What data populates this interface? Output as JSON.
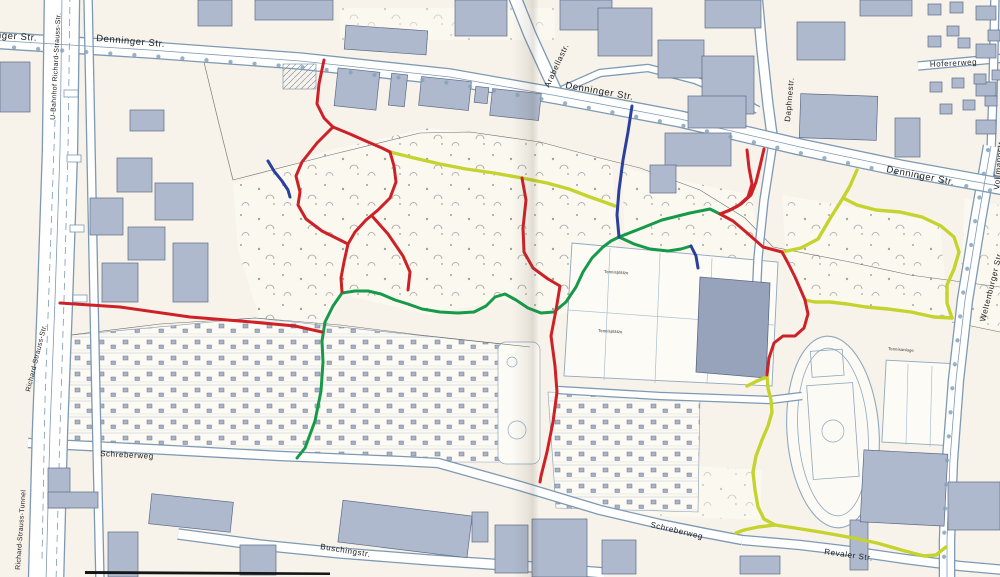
{
  "map": {
    "labels": {
      "denninger_1": "Denninger Str.",
      "denninger_2": "Denninger Str.",
      "denninger_3": "Denninger Str.",
      "denninger_4": "Denninger Str.",
      "arabellastr": "Arabellastr.",
      "daphnestr": "Daphnestr.",
      "hofererweg": "Hofererweg",
      "vollmannstr": "Vollmannstr.",
      "weltenburger": "Weltenburger Str.",
      "u_bahnhof": "U-Bahnhof Richard-Strauss-Str.",
      "richard_strauss_str": "Richard-Strauss-Str.",
      "richard_strauss_tunnel": "Richard-Strauss-Tunnel",
      "schreberweg_west": "Schreberweg",
      "schreberweg_east": "Schreberweg",
      "revaler_str": "Revaler Str.",
      "buschingstr": "Buschingstr.",
      "tennisplaetze_1": "Tennisplätze",
      "tennisplaetze_2": "Tennisplätze",
      "tennisanlage": "Tennisanlage"
    },
    "route_colors": {
      "red": "#cd2027",
      "green": "#169a49",
      "blue": "#2b3f9f",
      "yellow_green": "#c5d32e"
    },
    "routes": [
      {
        "name": "red-west",
        "color": "red",
        "points": [
          [
            60,
            303
          ],
          [
            120,
            307
          ],
          [
            190,
            317
          ],
          [
            252,
            322
          ],
          [
            295,
            326
          ],
          [
            322,
            332
          ]
        ]
      },
      {
        "name": "red-loop-stem",
        "color": "red",
        "points": [
          [
            324,
            60
          ],
          [
            319,
            84
          ],
          [
            317,
            104
          ],
          [
            324,
            118
          ],
          [
            333,
            127
          ]
        ]
      },
      {
        "name": "red-loop-west",
        "color": "red",
        "points": [
          [
            333,
            127
          ],
          [
            317,
            143
          ],
          [
            302,
            162
          ],
          [
            296,
            176
          ],
          [
            300,
            192
          ],
          [
            298,
            205
          ],
          [
            306,
            219
          ],
          [
            322,
            231
          ],
          [
            338,
            239
          ],
          [
            348,
            244
          ]
        ]
      },
      {
        "name": "red-loop-east",
        "color": "red",
        "points": [
          [
            390,
            152
          ],
          [
            394,
            166
          ],
          [
            396,
            182
          ],
          [
            390,
            198
          ],
          [
            378,
            210
          ],
          [
            366,
            220
          ],
          [
            355,
            232
          ],
          [
            348,
            244
          ]
        ]
      },
      {
        "name": "red-loop-north",
        "color": "red",
        "points": [
          [
            333,
            127
          ],
          [
            350,
            134
          ],
          [
            368,
            142
          ],
          [
            382,
            148
          ],
          [
            390,
            152
          ]
        ]
      },
      {
        "name": "red-tail-south",
        "color": "red",
        "points": [
          [
            348,
            244
          ],
          [
            344,
            262
          ],
          [
            341,
            278
          ],
          [
            342,
            292
          ]
        ]
      },
      {
        "name": "red-branch-southeast",
        "color": "red",
        "points": [
          [
            372,
            216
          ],
          [
            388,
            234
          ],
          [
            403,
            256
          ],
          [
            410,
            272
          ],
          [
            408,
            290
          ]
        ]
      },
      {
        "name": "red-center-south",
        "color": "red",
        "points": [
          [
            522,
            178
          ],
          [
            526,
            200
          ],
          [
            523,
            228
          ],
          [
            524,
            252
          ],
          [
            533,
            268
          ],
          [
            548,
            279
          ],
          [
            560,
            286
          ],
          [
            556,
            310
          ],
          [
            551,
            336
          ],
          [
            555,
            366
          ],
          [
            557,
            392
          ],
          [
            553,
            422
          ],
          [
            547,
            452
          ],
          [
            541,
            476
          ],
          [
            540,
            482
          ]
        ]
      },
      {
        "name": "red-east-fork-west",
        "color": "red",
        "points": [
          [
            747,
            150
          ],
          [
            749,
            168
          ],
          [
            752,
            184
          ],
          [
            748,
            197
          ],
          [
            738,
            206
          ],
          [
            728,
            211
          ],
          [
            720,
            214
          ]
        ]
      },
      {
        "name": "red-east-fork-east",
        "color": "red",
        "points": [
          [
            764,
            149
          ],
          [
            760,
            166
          ],
          [
            756,
            182
          ],
          [
            751,
            195
          ],
          [
            741,
            204
          ],
          [
            730,
            210
          ],
          [
            720,
            214
          ]
        ]
      },
      {
        "name": "red-east-main",
        "color": "red",
        "points": [
          [
            720,
            214
          ],
          [
            733,
            221
          ],
          [
            746,
            232
          ],
          [
            763,
            247
          ],
          [
            782,
            252
          ],
          [
            788,
            263
          ],
          [
            795,
            277
          ],
          [
            802,
            293
          ],
          [
            805,
            300
          ],
          [
            808,
            314
          ],
          [
            804,
            328
          ],
          [
            795,
            336
          ],
          [
            783,
            336
          ],
          [
            774,
            343
          ],
          [
            769,
            358
          ],
          [
            767,
            375
          ]
        ]
      },
      {
        "name": "green-main",
        "color": "green",
        "points": [
          [
            297,
            458
          ],
          [
            305,
            448
          ],
          [
            315,
            421
          ],
          [
            321,
            391
          ],
          [
            323,
            362
          ],
          [
            322,
            341
          ],
          [
            325,
            322
          ],
          [
            333,
            306
          ],
          [
            342,
            293
          ],
          [
            355,
            291
          ],
          [
            368,
            291
          ],
          [
            381,
            294
          ],
          [
            395,
            300
          ],
          [
            408,
            304
          ],
          [
            422,
            309
          ],
          [
            440,
            312
          ],
          [
            458,
            313
          ],
          [
            474,
            312
          ],
          [
            486,
            306
          ],
          [
            495,
            297
          ],
          [
            505,
            294
          ],
          [
            516,
            300
          ],
          [
            528,
            308
          ],
          [
            541,
            313
          ],
          [
            554,
            312
          ],
          [
            566,
            302
          ],
          [
            576,
            287
          ],
          [
            583,
            272
          ],
          [
            592,
            258
          ],
          [
            603,
            247
          ],
          [
            611,
            241
          ],
          [
            619,
            237
          ],
          [
            637,
            230
          ],
          [
            662,
            220
          ],
          [
            690,
            213
          ],
          [
            710,
            209
          ],
          [
            720,
            214
          ]
        ]
      },
      {
        "name": "green-spur",
        "color": "green",
        "points": [
          [
            619,
            237
          ],
          [
            634,
            244
          ],
          [
            650,
            249
          ],
          [
            668,
            251
          ],
          [
            681,
            249
          ],
          [
            691,
            246
          ]
        ]
      },
      {
        "name": "yellow-middle",
        "color": "yellow_green",
        "points": [
          [
            390,
            152
          ],
          [
            414,
            158
          ],
          [
            440,
            164
          ],
          [
            466,
            169
          ],
          [
            494,
            173
          ],
          [
            522,
            178
          ],
          [
            547,
            183
          ],
          [
            569,
            189
          ],
          [
            590,
            197
          ],
          [
            607,
            203
          ],
          [
            615,
            206
          ]
        ]
      },
      {
        "name": "yellow-east-stem",
        "color": "yellow_green",
        "points": [
          [
            857,
            170
          ],
          [
            850,
            186
          ],
          [
            843,
            198
          ]
        ]
      },
      {
        "name": "yellow-east-southwest",
        "color": "yellow_green",
        "points": [
          [
            843,
            198
          ],
          [
            831,
            217
          ],
          [
            818,
            239
          ],
          [
            801,
            248
          ],
          [
            782,
            252
          ]
        ]
      },
      {
        "name": "yellow-east-loop-north",
        "color": "yellow_green",
        "points": [
          [
            843,
            198
          ],
          [
            857,
            205
          ],
          [
            876,
            210
          ],
          [
            900,
            212
          ],
          [
            922,
            217
          ],
          [
            941,
            226
          ],
          [
            954,
            237
          ],
          [
            959,
            252
          ],
          [
            954,
            269
          ],
          [
            947,
            285
          ],
          [
            947,
            303
          ],
          [
            952,
            318
          ]
        ]
      },
      {
        "name": "yellow-east-loop-south",
        "color": "yellow_green",
        "points": [
          [
            952,
            318
          ],
          [
            934,
            317
          ],
          [
            911,
            312
          ],
          [
            888,
            309
          ],
          [
            866,
            307
          ],
          [
            847,
            304
          ],
          [
            830,
            302
          ],
          [
            815,
            302
          ],
          [
            805,
            300
          ]
        ]
      },
      {
        "name": "yellow-stadium-west",
        "color": "yellow_green",
        "points": [
          [
            767,
            375
          ],
          [
            768,
            388
          ],
          [
            771,
            400
          ],
          [
            772,
            412
          ],
          [
            768,
            426
          ],
          [
            762,
            440
          ],
          [
            756,
            456
          ],
          [
            753,
            472
          ],
          [
            755,
            490
          ],
          [
            758,
            507
          ],
          [
            764,
            519
          ],
          [
            775,
            525
          ],
          [
            795,
            528
          ],
          [
            820,
            532
          ],
          [
            848,
            537
          ],
          [
            877,
            543
          ],
          [
            905,
            551
          ],
          [
            924,
            556
          ],
          [
            936,
            555
          ],
          [
            946,
            547
          ]
        ]
      },
      {
        "name": "yellow-stub-upper",
        "color": "yellow_green",
        "points": [
          [
            767,
            377
          ],
          [
            757,
            381
          ],
          [
            747,
            386
          ]
        ]
      },
      {
        "name": "yellow-stub-lower",
        "color": "yellow_green",
        "points": [
          [
            775,
            525
          ],
          [
            758,
            527
          ],
          [
            744,
            530
          ],
          [
            736,
            533
          ]
        ]
      },
      {
        "name": "blue-arabella",
        "color": "blue",
        "points": [
          [
            632,
            106
          ],
          [
            628,
            132
          ],
          [
            623,
            160
          ],
          [
            619,
            190
          ],
          [
            617,
            215
          ],
          [
            619,
            237
          ]
        ]
      },
      {
        "name": "blue-spur-east",
        "color": "blue",
        "points": [
          [
            691,
            246
          ],
          [
            696,
            256
          ],
          [
            698,
            268
          ]
        ]
      },
      {
        "name": "blue-west",
        "color": "blue",
        "points": [
          [
            268,
            161
          ],
          [
            274,
            171
          ],
          [
            282,
            181
          ],
          [
            288,
            190
          ],
          [
            290,
            197
          ]
        ]
      }
    ]
  }
}
